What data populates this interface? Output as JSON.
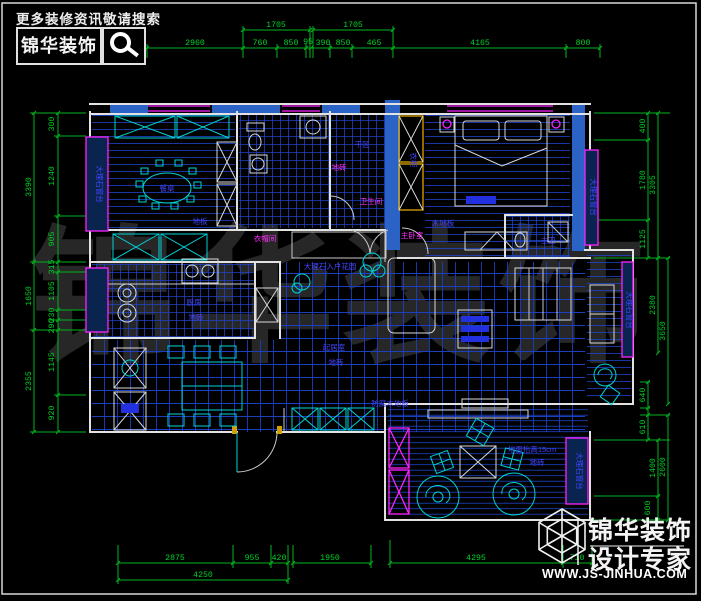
{
  "header": {
    "tagline": "更多装修资讯敬请搜索",
    "brand": "锦华装饰"
  },
  "watermark": "锦华装饰",
  "footer": {
    "brand_line1": "锦华装饰",
    "brand_line2": "设计专家",
    "website": "WWW.JS-JINHUA.COM"
  },
  "dims": {
    "top": [
      "2960",
      "1705",
      "1705",
      "760",
      "850",
      "95",
      "390",
      "850",
      "465",
      "4165",
      "800"
    ],
    "left": [
      "300",
      "1240",
      "905",
      "315",
      "1105",
      "230",
      "290",
      "1145",
      "920",
      "3390",
      "1650",
      "2355"
    ],
    "right": [
      "400",
      "1780",
      "1125",
      "640",
      "610",
      "3305",
      "2380",
      "1400",
      "600",
      "3650",
      "2600"
    ],
    "bottom": [
      "2875",
      "955",
      "420",
      "1950",
      "4295",
      "710",
      "4250"
    ]
  },
  "labels": {
    "dining_table": "餐桌",
    "dining_floor": "地板",
    "dry_area": "干区",
    "bath_tile": "地砖",
    "bathroom": "卫生间",
    "wardrobe": "衣柜",
    "cloakroom": "衣帽间",
    "master_bedroom": "主卧室",
    "wood_floor": "木地板",
    "master_bath": "主卫",
    "kitchen": "厨房",
    "kitchen_tile": "地砖",
    "living_room": "起居室",
    "living_tile": "地砖",
    "entry_garden": "大理石入户花园",
    "deck_floor": "防腐木地板",
    "raised_floor": "地面抬高15cm",
    "raised_tile": "地砖",
    "window_sill": "大理石窗台"
  }
}
